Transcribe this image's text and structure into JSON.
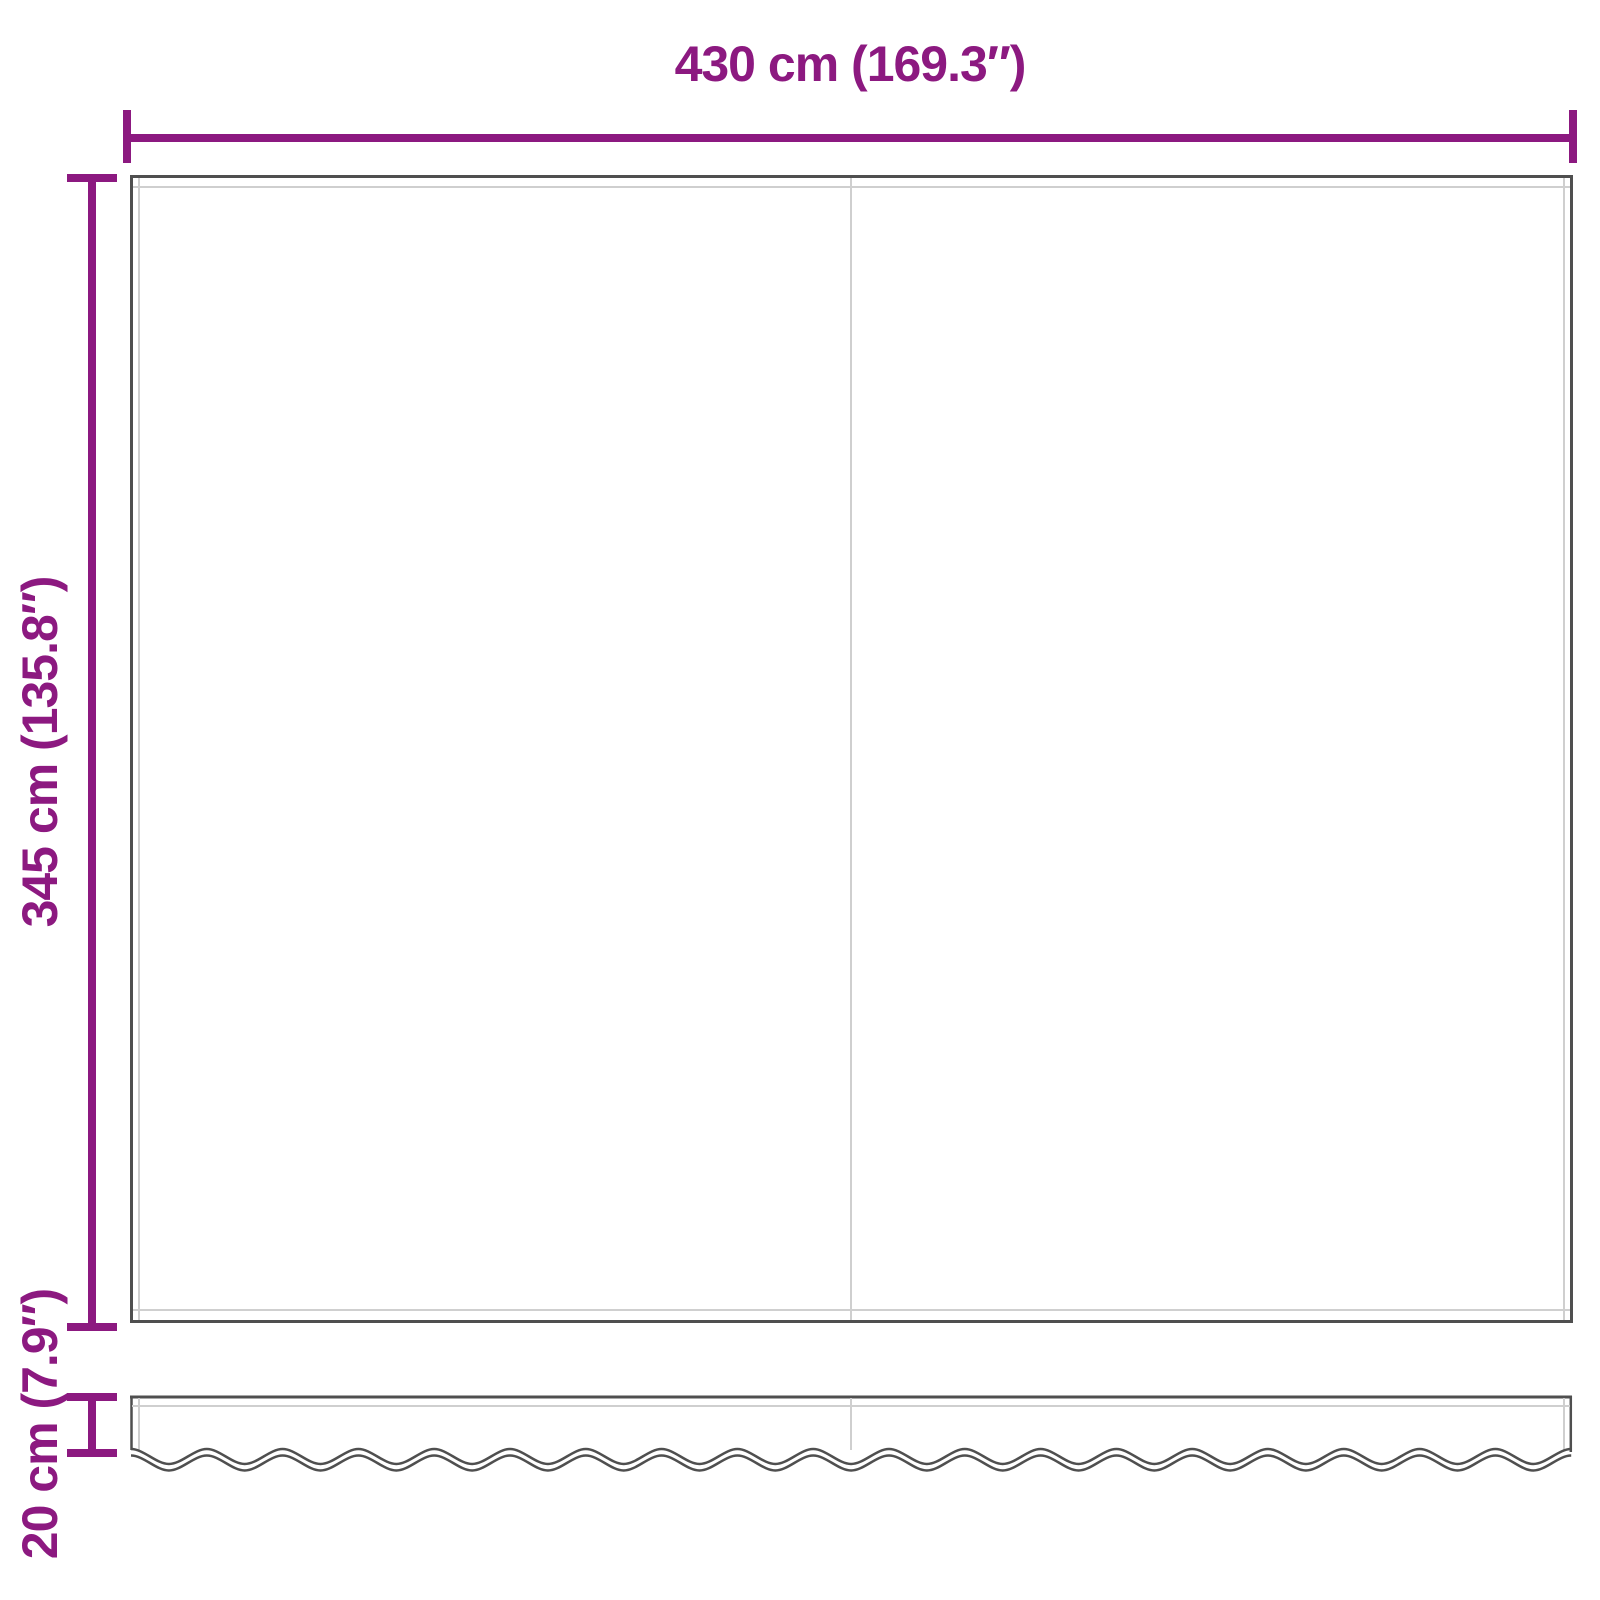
{
  "colors": {
    "accent": "#8C1980",
    "outline": "#4F4F4F",
    "inner": "#CFCFCF"
  },
  "diagram": {
    "type": "product-dimension-drawing",
    "subject": "awning-replacement-fabric-with-valance",
    "width_dimension": {
      "label": "430 cm (169.3″)",
      "cm": 430,
      "inches": 169.3
    },
    "height_dimension": {
      "label": "345 cm (135.8″)",
      "cm": 345,
      "inches": 135.8
    },
    "valance_height_dimension": {
      "label": "20 cm (7.9″)",
      "cm": 20,
      "inches": 7.9
    }
  }
}
